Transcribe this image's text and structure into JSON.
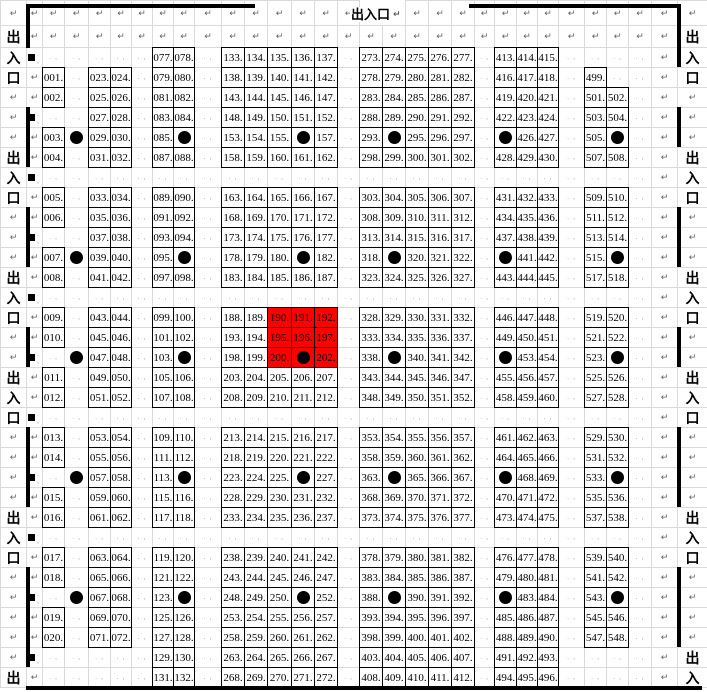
{
  "labels": {
    "entrance": "出入口",
    "entrance_chars": [
      "出",
      "入",
      "口"
    ]
  },
  "marks": {
    "pilcrow": "↵",
    "cell_mark": ". ,",
    "dot": "●",
    "square": "■"
  },
  "colors": {
    "background": "#ffffff",
    "grid_line": "#dadada",
    "box_border": "#000000",
    "highlight_bg": "#ff0000",
    "wall": "#000000",
    "text": "#000000",
    "mark": "#606060"
  },
  "top_entrance": {
    "text": "出入口",
    "x": 350,
    "y": 7,
    "h": 15
  },
  "grid": {
    "col_widths": [
      26,
      16,
      22,
      24,
      22,
      21,
      21,
      21,
      21,
      27,
      23,
      23,
      24,
      23,
      23,
      22,
      23,
      23,
      23,
      23,
      23,
      20,
      22,
      21,
      21,
      26,
      22,
      22,
      23,
      26,
      30
    ],
    "row_heights": [
      25,
      22,
      20,
      20,
      20,
      20,
      20,
      20,
      20,
      20,
      20,
      20,
      20,
      20,
      20,
      20,
      20,
      20,
      20,
      20,
      20,
      20,
      20,
      20,
      20,
      20,
      20,
      20,
      20,
      20,
      20,
      20,
      20,
      20
    ],
    "rows": [
      [
        "p",
        "p",
        "p",
        "p",
        "p",
        "p",
        "p",
        "p",
        "p",
        "p",
        "p",
        "p",
        "p",
        "p",
        "p",
        "p",
        "",
        "",
        "p",
        "p",
        "p",
        "p",
        "p",
        "p",
        "p",
        "p",
        "p",
        "p",
        "p",
        "p",
        "p"
      ],
      [
        "z:出",
        "p",
        "p",
        "p",
        "p",
        "p",
        "p",
        "p",
        "p",
        "p",
        "p",
        "p",
        "p",
        "p",
        "p",
        "p",
        "p",
        "p",
        "p",
        "p",
        "p",
        "p",
        "p",
        "p",
        "p",
        "p",
        "p",
        "p",
        "p",
        "p",
        "z:出"
      ],
      [
        "z:入",
        "s",
        ".",
        ".",
        ".",
        ".",
        ".",
        "n:077",
        "n:078",
        ".",
        "n:133",
        "n:134",
        "n:135",
        "n:136",
        "n:137",
        ".",
        "n:273",
        "n:274",
        "n:275",
        "n:276",
        "n:277",
        ".",
        "n:413",
        "n:414",
        "n:415",
        ".",
        ".",
        ".",
        ".",
        "p",
        "z:入"
      ],
      [
        "z:口",
        "p",
        "n:001",
        ".",
        "n:023",
        "n:024",
        ".",
        "n:079",
        "n:080",
        ".",
        "n:138",
        "n:139",
        "n:140",
        "n:141",
        "n:142",
        ".",
        "n:278",
        "n:279",
        "n:280",
        "n:281",
        "n:282",
        ".",
        "n:416",
        "n:417",
        "n:418",
        ".",
        "n:499",
        ".",
        ".",
        "p",
        "z:口"
      ],
      [
        "p",
        "p",
        "n:002",
        ".",
        "n:025",
        "n:026",
        ".",
        "n:081",
        "n:082",
        ".",
        "n:143",
        "n:144",
        "n:145",
        "n:146",
        "n:147",
        ".",
        "n:283",
        "n:284",
        "n:285",
        "n:286",
        "n:287",
        ".",
        "n:419",
        "n:420",
        "n:421",
        ".",
        "n:501",
        "n:502",
        ".",
        "p",
        "p"
      ],
      [
        "p",
        "s",
        ".",
        ".",
        "n:027",
        "n:028",
        ".",
        "n:083",
        "n:084",
        ".",
        "n:148",
        "n:149",
        "n:150",
        "n:151",
        "n:152",
        ".",
        "n:288",
        "n:289",
        "n:290",
        "n:291",
        "n:292",
        ".",
        "n:422",
        "n:423",
        "n:424",
        ".",
        "n:503",
        "n:504",
        ".",
        "p",
        "p"
      ],
      [
        "p",
        "p",
        "n:003",
        "dp",
        "n:029",
        "n:030",
        ".",
        "n:085",
        "d",
        ".",
        "n:153",
        "n:154",
        "n:155",
        "d",
        "n:157",
        ".",
        "n:293",
        "d",
        "n:295",
        "n:296",
        "n:297",
        ".",
        "d",
        "n:426",
        "n:427",
        ".",
        "n:505",
        "d",
        ".",
        "p",
        "p"
      ],
      [
        "z:出",
        "p",
        "n:004",
        ".",
        "n:031",
        "n:032",
        ".",
        "n:087",
        "n:088",
        ".",
        "n:158",
        "n:159",
        "n:160",
        "n:161",
        "n:162",
        ".",
        "n:298",
        "n:299",
        "n:300",
        "n:301",
        "n:302",
        ".",
        "n:428",
        "n:429",
        "n:430",
        ".",
        "n:507",
        "n:508",
        ".",
        "p",
        "z:出"
      ],
      [
        "z:入",
        "s",
        ".",
        ".",
        ".",
        ".",
        ".",
        ".",
        ".",
        ".",
        ".",
        ".",
        ".",
        ".",
        ".",
        ".",
        ".",
        ".",
        ".",
        ".",
        ".",
        ".",
        ".",
        ".",
        ".",
        ".",
        ".",
        ".",
        ".",
        "p",
        "z:入"
      ],
      [
        "z:口",
        "p",
        "n:005",
        ".",
        "n:033",
        "n:034",
        ".",
        "n:089",
        "n:090",
        ".",
        "n:163",
        "n:164",
        "n:165",
        "n:166",
        "n:167",
        ".",
        "n:303",
        "n:304",
        "n:305",
        "n:306",
        "n:307",
        ".",
        "n:431",
        "n:432",
        "n:433",
        ".",
        "n:509",
        "n:510",
        ".",
        "p",
        "z:口"
      ],
      [
        "p",
        "p",
        "n:006",
        ".",
        "n:035",
        "n:036",
        ".",
        "n:091",
        "n:092",
        ".",
        "n:168",
        "n:169",
        "n:170",
        "n:171",
        "n:172",
        ".",
        "n:308",
        "n:309",
        "n:310",
        "n:311",
        "n:312",
        ".",
        "n:434",
        "n:435",
        "n:436",
        ".",
        "n:511",
        "n:512",
        ".",
        "p",
        "p"
      ],
      [
        "p",
        "s",
        ".",
        ".",
        "n:037",
        "n:038",
        ".",
        "n:093",
        "n:094",
        ".",
        "n:173",
        "n:174",
        "n:175",
        "n:176",
        "n:177",
        ".",
        "n:313",
        "n:314",
        "n:315",
        "n:316",
        "n:317",
        ".",
        "n:437",
        "n:438",
        "n:439",
        ".",
        "n:513",
        "n:514",
        ".",
        "p",
        "p"
      ],
      [
        "p",
        "p",
        "n:007",
        "dp",
        "n:039",
        "n:040",
        ".",
        "n:095",
        "d",
        ".",
        "n:178",
        "n:179",
        "n:180",
        "d",
        "n:182",
        ".",
        "n:318",
        "d",
        "n:320",
        "n:321",
        "n:322",
        ".",
        "d",
        "n:441",
        "n:442",
        ".",
        "n:515",
        "d",
        ".",
        "p",
        "p"
      ],
      [
        "z:出",
        "p",
        "n:008",
        ".",
        "n:041",
        "n:042",
        ".",
        "n:097",
        "n:098",
        ".",
        "n:183",
        "n:184",
        "n:185",
        "n:186",
        "n:187",
        ".",
        "n:323",
        "n:324",
        "n:325",
        "n:326",
        "n:327",
        ".",
        "n:443",
        "n:444",
        "n:445",
        ".",
        "n:517",
        "n:518",
        ".",
        "p",
        "z:出"
      ],
      [
        "z:入",
        "s",
        ".",
        ".",
        ".",
        ".",
        ".",
        ".",
        ".",
        ".",
        ".",
        ".",
        ".",
        ".",
        ".",
        ".",
        ".",
        ".",
        ".",
        ".",
        ".",
        ".",
        ".",
        ".",
        ".",
        ".",
        ".",
        ".",
        ".",
        "p",
        "z:入"
      ],
      [
        "z:口",
        "p",
        "n:009",
        ".",
        "n:043",
        "n:044",
        ".",
        "n:099",
        "n:100",
        ".",
        "n:188",
        "n:189",
        "r:190",
        "r:191",
        "r:192",
        ".",
        "n:328",
        "n:329",
        "n:330",
        "n:331",
        "n:332",
        ".",
        "n:446",
        "n:447",
        "n:448",
        ".",
        "n:519",
        "n:520",
        ".",
        "p",
        "z:口"
      ],
      [
        "p",
        "p",
        "n:010",
        ".",
        "n:045",
        "n:046",
        ".",
        "n:101",
        "n:102",
        ".",
        "n:193",
        "n:194",
        "r:195",
        "r:196",
        "r:197",
        ".",
        "n:333",
        "n:334",
        "n:335",
        "n:336",
        "n:337",
        ".",
        "n:449",
        "n:450",
        "n:451",
        ".",
        "n:521",
        "n:522",
        ".",
        "p",
        "p"
      ],
      [
        "p",
        "s",
        ".",
        "dp",
        "n:047",
        "n:048",
        ".",
        "n:103",
        "d",
        ".",
        "n:198",
        "n:199",
        "r:200",
        "rd",
        "r:202",
        ".",
        "n:338",
        "d",
        "n:340",
        "n:341",
        "n:342",
        ".",
        "d",
        "n:453",
        "n:454",
        ".",
        "n:523",
        "d",
        ".",
        "p",
        "p"
      ],
      [
        "z:出",
        "p",
        "n:011",
        ".",
        "n:049",
        "n:050",
        ".",
        "n:105",
        "n:106",
        ".",
        "n:203",
        "n:204",
        "n:205",
        "n:206",
        "n:207",
        ".",
        "n:343",
        "n:344",
        "n:345",
        "n:346",
        "n:347",
        ".",
        "n:455",
        "n:456",
        "n:457",
        ".",
        "n:525",
        "n:526",
        ".",
        "p",
        "z:出"
      ],
      [
        "z:入",
        "p",
        "n:012",
        ".",
        "n:051",
        "n:052",
        ".",
        "n:107",
        "n:108",
        ".",
        "n:208",
        "n:209",
        "n:210",
        "n:211",
        "n:212",
        ".",
        "n:348",
        "n:349",
        "n:350",
        "n:351",
        "n:352",
        ".",
        "n:458",
        "n:459",
        "n:460",
        ".",
        "n:527",
        "n:528",
        ".",
        "p",
        "z:入"
      ],
      [
        "z:口",
        "s",
        ".",
        ".",
        ".",
        ".",
        ".",
        ".",
        ".",
        ".",
        ".",
        ".",
        ".",
        ".",
        ".",
        ".",
        ".",
        ".",
        ".",
        ".",
        ".",
        ".",
        ".",
        ".",
        ".",
        ".",
        ".",
        ".",
        ".",
        "p",
        "z:口"
      ],
      [
        "p",
        "p",
        "n:013",
        ".",
        "n:053",
        "n:054",
        ".",
        "n:109",
        "n:110",
        ".",
        "n:213",
        "n:214",
        "n:215",
        "n:216",
        "n:217",
        ".",
        "n:353",
        "n:354",
        "n:355",
        "n:356",
        "n:357",
        ".",
        "n:461",
        "n:462",
        "n:463",
        ".",
        "n:529",
        "n:530",
        ".",
        "p",
        "p"
      ],
      [
        "p",
        "p",
        "n:014",
        ".",
        "n:055",
        "n:056",
        ".",
        "n:111",
        "n:112",
        ".",
        "n:218",
        "n:219",
        "n:220",
        "n:221",
        "n:222",
        ".",
        "n:358",
        "n:359",
        "n:360",
        "n:361",
        "n:362",
        ".",
        "n:464",
        "n:465",
        "n:466",
        ".",
        "n:531",
        "n:532",
        ".",
        "p",
        "p"
      ],
      [
        "p",
        "s",
        ".",
        "dp",
        "n:057",
        "n:058",
        ".",
        "n:113",
        "d",
        ".",
        "n:223",
        "n:224",
        "n:225",
        "d",
        "n:227",
        ".",
        "n:363",
        "d",
        "n:365",
        "n:366",
        "n:367",
        ".",
        "d",
        "n:468",
        "n:469",
        ".",
        "n:533",
        "d",
        ".",
        "p",
        "p"
      ],
      [
        "p",
        "p",
        "n:015",
        ".",
        "n:059",
        "n:060",
        ".",
        "n:115",
        "n:116",
        ".",
        "n:228",
        "n:229",
        "n:230",
        "n:231",
        "n:232",
        ".",
        "n:368",
        "n:369",
        "n:370",
        "n:371",
        "n:372",
        ".",
        "n:470",
        "n:471",
        "n:472",
        ".",
        "n:535",
        "n:536",
        ".",
        "p",
        "p"
      ],
      [
        "z:出",
        "p",
        "n:016",
        ".",
        "n:061",
        "n:062",
        ".",
        "n:117",
        "n:118",
        ".",
        "n:233",
        "n:234",
        "n:235",
        "n:236",
        "n:237",
        ".",
        "n:373",
        "n:374",
        "n:375",
        "n:376",
        "n:377",
        ".",
        "n:473",
        "n:474",
        "n:475",
        ".",
        "n:537",
        "n:538",
        ".",
        "p",
        "z:出"
      ],
      [
        "z:入",
        "s",
        ".",
        ".",
        ".",
        ".",
        ".",
        ".",
        ".",
        ".",
        ".",
        ".",
        ".",
        ".",
        ".",
        ".",
        ".",
        ".",
        ".",
        ".",
        ".",
        ".",
        ".",
        ".",
        ".",
        ".",
        ".",
        ".",
        ".",
        "p",
        "z:入"
      ],
      [
        "z:口",
        "p",
        "n:017",
        ".",
        "n:063",
        "n:064",
        ".",
        "n:119",
        "n:120",
        ".",
        "n:238",
        "n:239",
        "n:240",
        "n:241",
        "n:242",
        ".",
        "n:378",
        "n:379",
        "n:380",
        "n:381",
        "n:382",
        ".",
        "n:476",
        "n:477",
        "n:478",
        ".",
        "n:539",
        "n:540",
        ".",
        "p",
        "z:口"
      ],
      [
        "p",
        "p",
        "n:018",
        ".",
        "n:065",
        "n:066",
        ".",
        "n:121",
        "n:122",
        ".",
        "n:243",
        "n:244",
        "n:245",
        "n:246",
        "n:247",
        ".",
        "n:383",
        "n:384",
        "n:385",
        "n:386",
        "n:387",
        ".",
        "n:479",
        "n:480",
        "n:481",
        ".",
        "n:541",
        "n:542",
        ".",
        "p",
        "p"
      ],
      [
        "p",
        "s",
        ".",
        "dp",
        "n:067",
        "n:068",
        ".",
        "n:123",
        "d",
        ".",
        "n:248",
        "n:249",
        "n:250",
        "d",
        "n:252",
        ".",
        "n:388",
        "d",
        "n:390",
        "n:391",
        "n:392",
        ".",
        "d",
        "n:483",
        "n:484",
        ".",
        "n:543",
        "d",
        ".",
        "p",
        "p"
      ],
      [
        "p",
        "p",
        "n:019",
        ".",
        "n:069",
        "n:070",
        ".",
        "n:125",
        "n:126",
        ".",
        "n:253",
        "n:254",
        "n:255",
        "n:256",
        "n:257",
        ".",
        "n:393",
        "n:394",
        "n:395",
        "n:396",
        "n:397",
        ".",
        "n:485",
        "n:486",
        "n:487",
        ".",
        "n:545",
        "n:546",
        ".",
        "p",
        "p"
      ],
      [
        "p",
        "p",
        "n:020",
        ".",
        "n:071",
        "n:072",
        ".",
        "n:127",
        "n:128",
        ".",
        "n:258",
        "n:259",
        "n:260",
        "n:261",
        "n:262",
        ".",
        "n:398",
        "n:399",
        "n:400",
        "n:401",
        "n:402",
        ".",
        "n:488",
        "n:489",
        "n:490",
        ".",
        "n:547",
        "n:548",
        ".",
        "p",
        "p"
      ],
      [
        "p",
        "s",
        ".",
        ".",
        ".",
        ".",
        ".",
        "n:129",
        "n:130",
        ".",
        "n:263",
        "n:264",
        "n:265",
        "n:266",
        "n:267",
        ".",
        "n:403",
        "n:404",
        "n:405",
        "n:406",
        "n:407",
        ".",
        "n:491",
        "n:492",
        "n:493",
        ".",
        ".",
        ".",
        ".",
        "p",
        "z:出"
      ],
      [
        "z:出",
        "p",
        ".",
        ".",
        ".",
        ".",
        ".",
        "n:131",
        "n:132",
        ".",
        "n:268",
        "n:269",
        "n:270",
        "n:271",
        "n:272",
        ".",
        "n:408",
        "n:409",
        "n:410",
        "n:411",
        "n:412",
        ".",
        "n:494",
        "n:495",
        "n:496",
        ".",
        ".",
        ".",
        ".",
        "p",
        "z:入"
      ]
    ]
  },
  "walls": {
    "thickness": 4,
    "segments": [
      {
        "x": 26,
        "y": 4,
        "w": 229,
        "h": 4
      },
      {
        "x": 469,
        "y": 4,
        "w": 212,
        "h": 4
      },
      {
        "x": 26,
        "y": 686,
        "w": 676,
        "h": 4
      },
      {
        "x": 26,
        "y": 4,
        "w": 4,
        "h": 44
      },
      {
        "x": 26,
        "y": 107,
        "w": 4,
        "h": 60
      },
      {
        "x": 26,
        "y": 207,
        "w": 4,
        "h": 60
      },
      {
        "x": 26,
        "y": 327,
        "w": 4,
        "h": 40
      },
      {
        "x": 26,
        "y": 427,
        "w": 4,
        "h": 80
      },
      {
        "x": 26,
        "y": 567,
        "w": 4,
        "h": 100
      },
      {
        "x": 677,
        "y": 4,
        "w": 4,
        "h": 63
      },
      {
        "x": 677,
        "y": 107,
        "w": 4,
        "h": 40
      },
      {
        "x": 677,
        "y": 207,
        "w": 4,
        "h": 60
      },
      {
        "x": 677,
        "y": 327,
        "w": 4,
        "h": 40
      },
      {
        "x": 677,
        "y": 427,
        "w": 4,
        "h": 80
      },
      {
        "x": 677,
        "y": 567,
        "w": 4,
        "h": 80
      }
    ]
  }
}
